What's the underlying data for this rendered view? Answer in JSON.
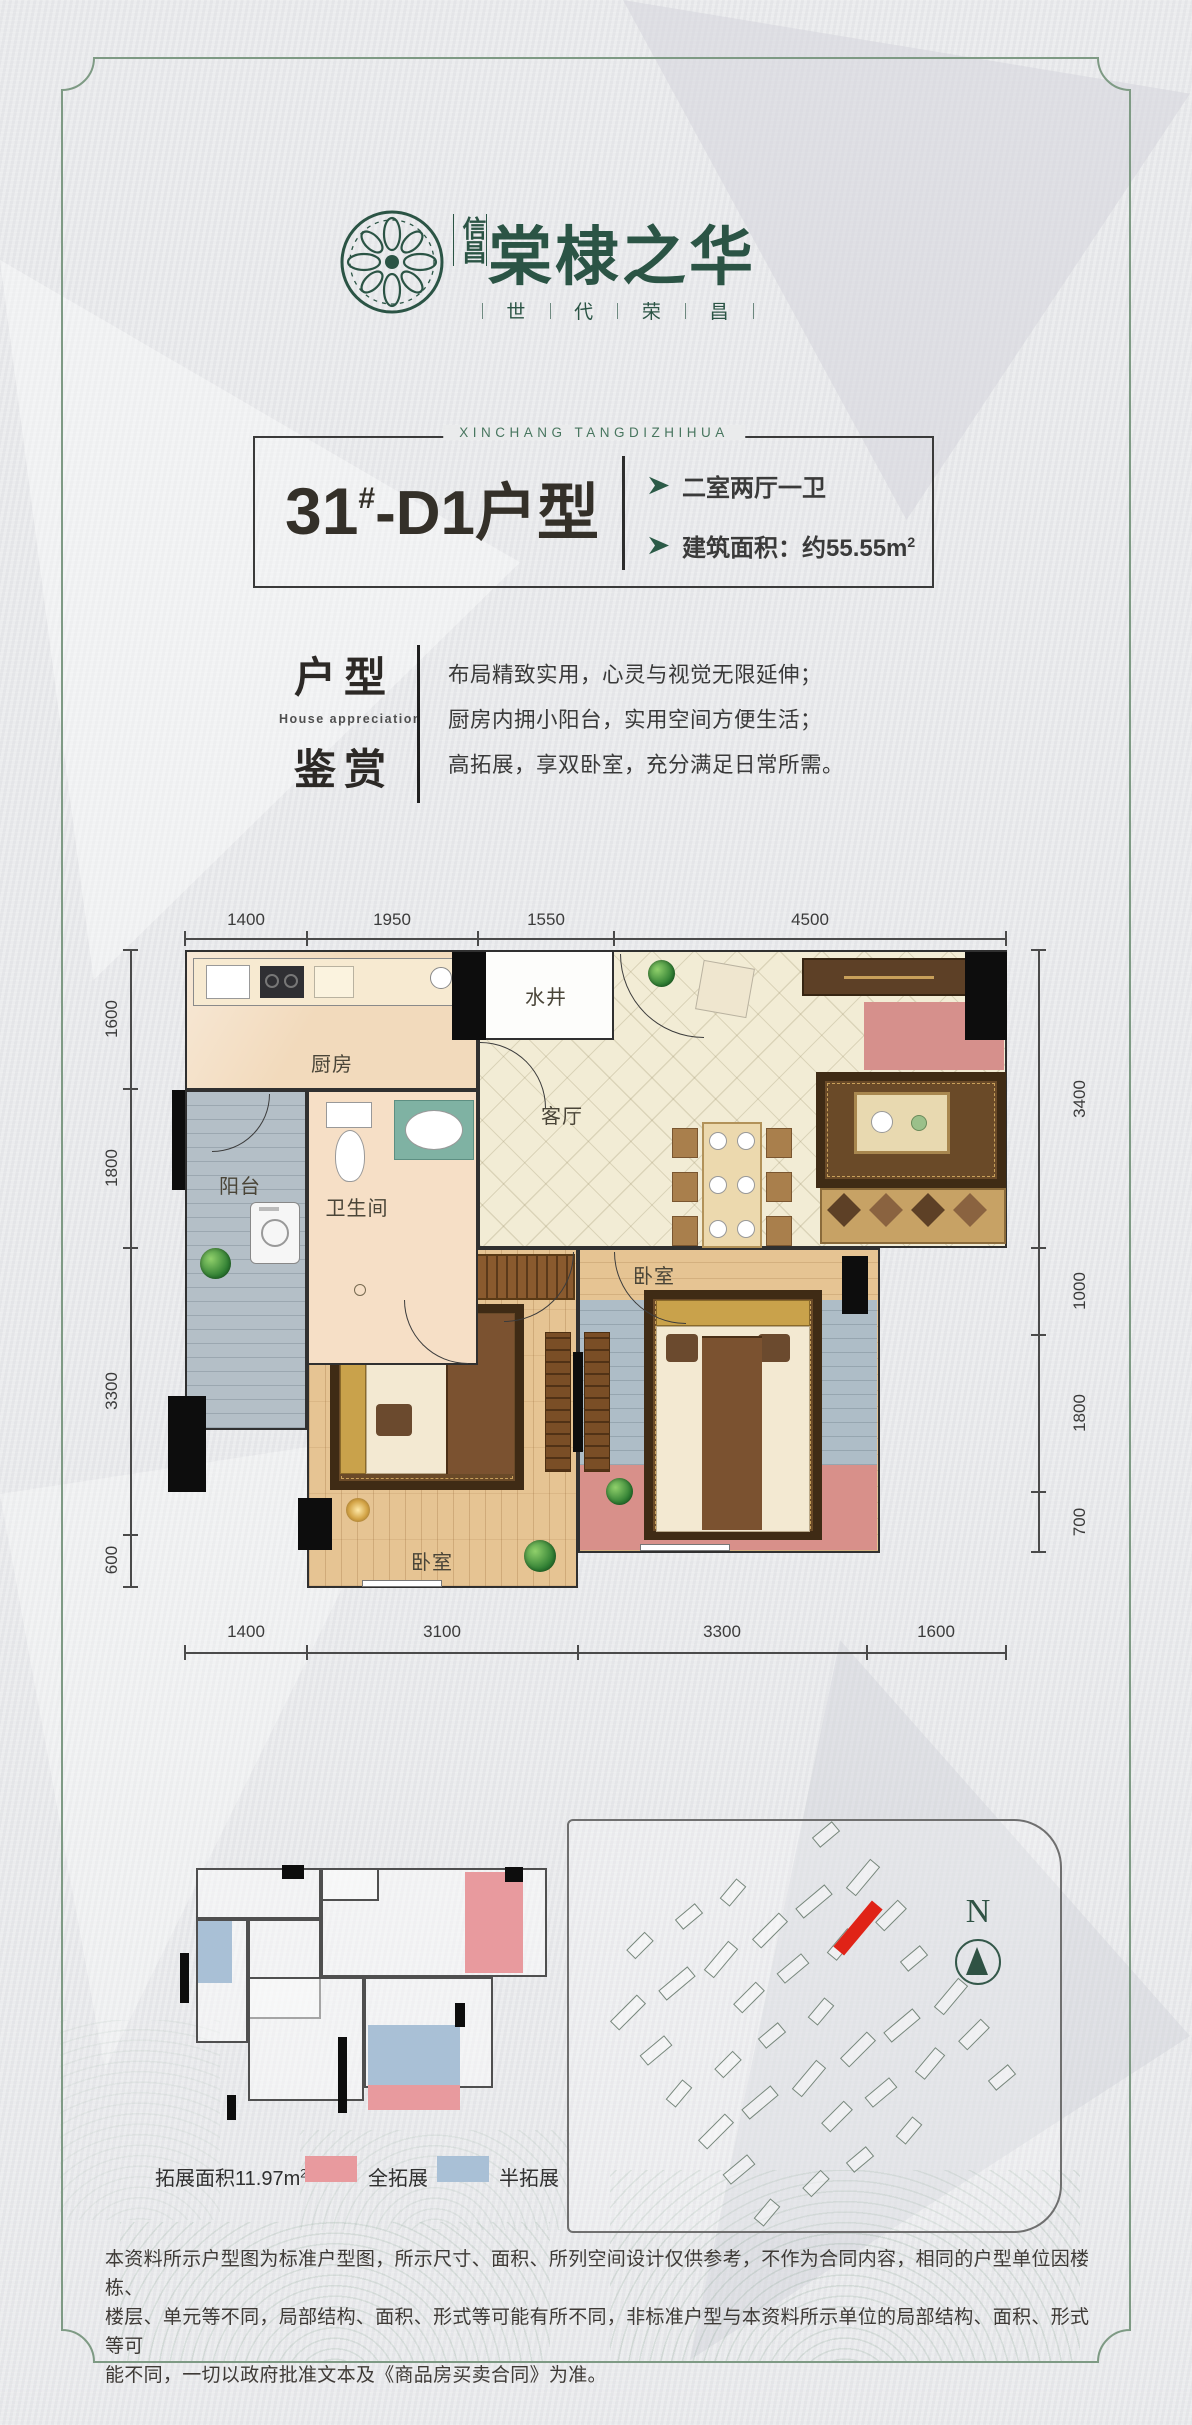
{
  "page": {
    "bg": "#e9eaec",
    "frame_color": "#7e9a84"
  },
  "logo": {
    "brand_small": "信昌",
    "brand_large": "棠棣之华",
    "slogan": [
      "世",
      "代",
      "荣",
      "昌"
    ],
    "latin": "XINCHANG TANGDIZHIHUA",
    "color": "#2b5445"
  },
  "title": {
    "number": "31",
    "number_sup": "#",
    "name": "-D1户型",
    "features": [
      {
        "text": "二室两厅一卫",
        "sup": ""
      },
      {
        "text": "建筑面积：约55.55m",
        "sup": "2"
      }
    ],
    "arrow_color": "#2b5a47"
  },
  "appreciation": {
    "zh1": "户型",
    "en": "House appreciation",
    "zh2": "鉴赏",
    "lines": [
      "布局精致实用，心灵与视觉无限延伸；",
      "厨房内拥小阳台，实用空间方便生活；",
      "高拓展，享双卧室，充分满足日常所需。"
    ]
  },
  "floorplan": {
    "rooms": {
      "kitchen": "厨房",
      "well": "水井",
      "living": "客厅",
      "bath": "卫生间",
      "balcony": "阳台",
      "bedroom1": "卧室",
      "bedroom2": "卧室"
    },
    "dims_top": [
      "1400",
      "1950",
      "1550",
      "4500"
    ],
    "dims_bottom": [
      "1400",
      "3100",
      "3300",
      "1600"
    ],
    "dims_left": [
      "1600",
      "1800",
      "3300",
      "600"
    ],
    "dims_right": [
      "3400",
      "1000",
      "1800",
      "700"
    ]
  },
  "expansion": {
    "area_label": "拓展面积11.97m",
    "area_sup": "2",
    "legend": [
      {
        "label": "全拓展",
        "color": "#e89a9e"
      },
      {
        "label": "半拓展",
        "color": "#a9c0d6"
      }
    ]
  },
  "site": {
    "north": "N",
    "highlight_color": "#e02317"
  },
  "disclaimer": [
    "本资料所示户型图为标准户型图，所示尺寸、面积、所列空间设计仅供参考，不作为合同内容，相同的户型单位因楼栋、",
    "楼层、单元等不同，局部结构、面积、形式等可能有所不同，非标准户型与本资料所示单位的局部结构、面积、形式等可",
    "能不同，一切以政府批准文本及《商品房买卖合同》为准。"
  ]
}
